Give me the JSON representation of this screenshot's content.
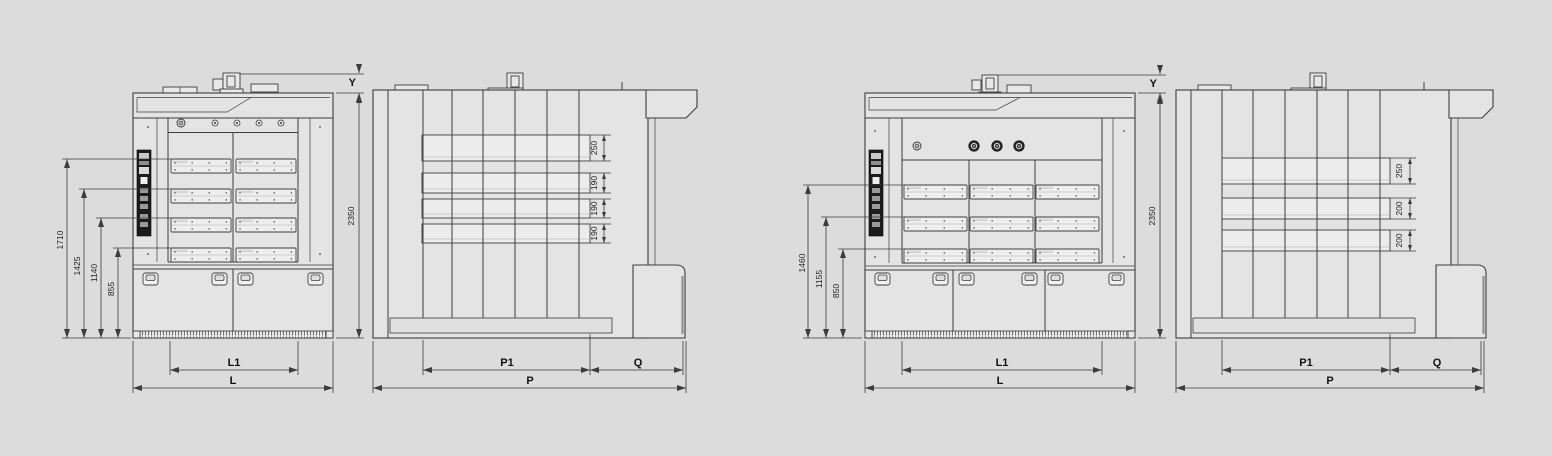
{
  "page": {
    "background": "#dcdcdc",
    "line_color": "#3d3d3d"
  },
  "diagram": {
    "oven1": {
      "front_view": {
        "deck_heights": [
          "1710",
          "1425",
          "1140",
          "855"
        ],
        "overall_height": "2350",
        "top_clearance": "Y",
        "inner_width": "L1",
        "overall_width": "L"
      },
      "side_view": {
        "deck_openings": [
          "250",
          "190",
          "190",
          "190"
        ],
        "inner_depth": "P1",
        "front_depth": "Q",
        "overall_depth": "P"
      }
    },
    "oven2": {
      "front_view": {
        "deck_heights": [
          "1460",
          "1155",
          "850"
        ],
        "overall_height": "2350",
        "top_clearance": "Y",
        "inner_width": "L1",
        "overall_width": "L"
      },
      "side_view": {
        "deck_openings": [
          "250",
          "200",
          "200"
        ],
        "inner_depth": "P1",
        "front_depth": "Q",
        "overall_depth": "P"
      }
    }
  }
}
